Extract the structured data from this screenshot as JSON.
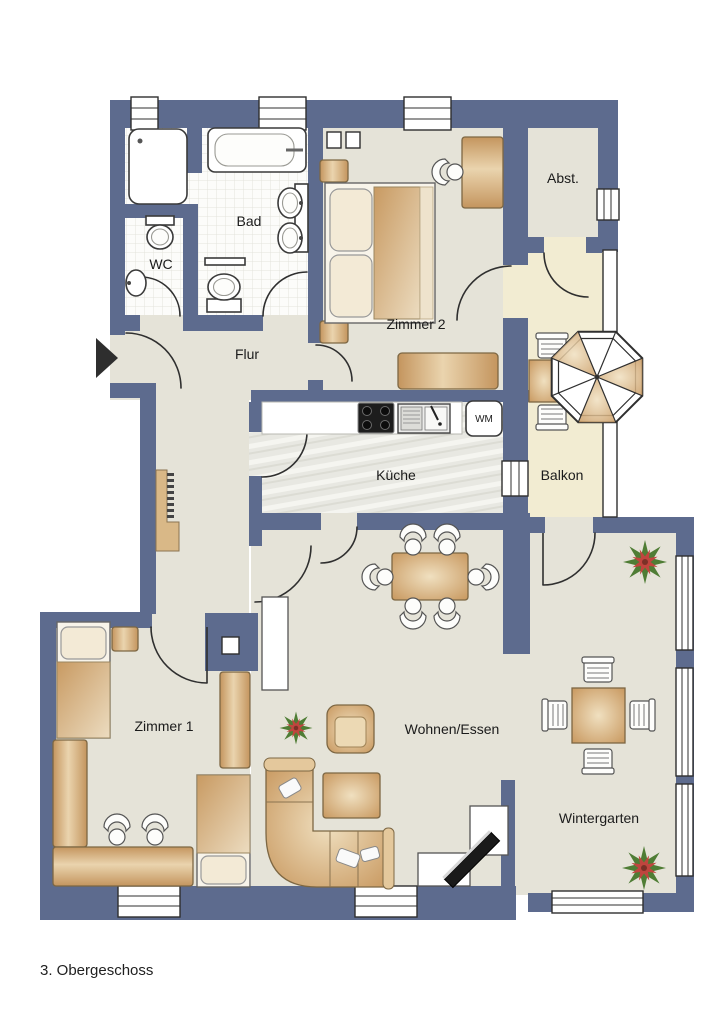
{
  "title_caption": "3. Obergeschoss",
  "rooms": [
    {
      "id": "bad",
      "label": "Bad"
    },
    {
      "id": "wc",
      "label": "WC"
    },
    {
      "id": "flur",
      "label": "Flur"
    },
    {
      "id": "zimmer2",
      "label": "Zimmer 2"
    },
    {
      "id": "abstellraum",
      "label": "Abst."
    },
    {
      "id": "kueche",
      "label": "Küche"
    },
    {
      "id": "balkon",
      "label": "Balkon"
    },
    {
      "id": "zimmer1",
      "label": "Zimmer 1"
    },
    {
      "id": "wohnen_essen",
      "label": "Wohnen/Essen"
    },
    {
      "id": "wintergarten",
      "label": "Wintergarten"
    }
  ],
  "appliances": {
    "washing_machine": "WM"
  },
  "colors": {
    "wall": "#5d6b8e",
    "floor": "#e5e3d8",
    "balcony_floor": "#f2ecd2",
    "bath_tile": "#fcfcfa",
    "kitchen_floor": "#e8e8e2",
    "furniture_wood": "#d9b988",
    "plant_green": "#4f7d35",
    "plant_red": "#c0453e",
    "line": "#2f2f2f"
  }
}
